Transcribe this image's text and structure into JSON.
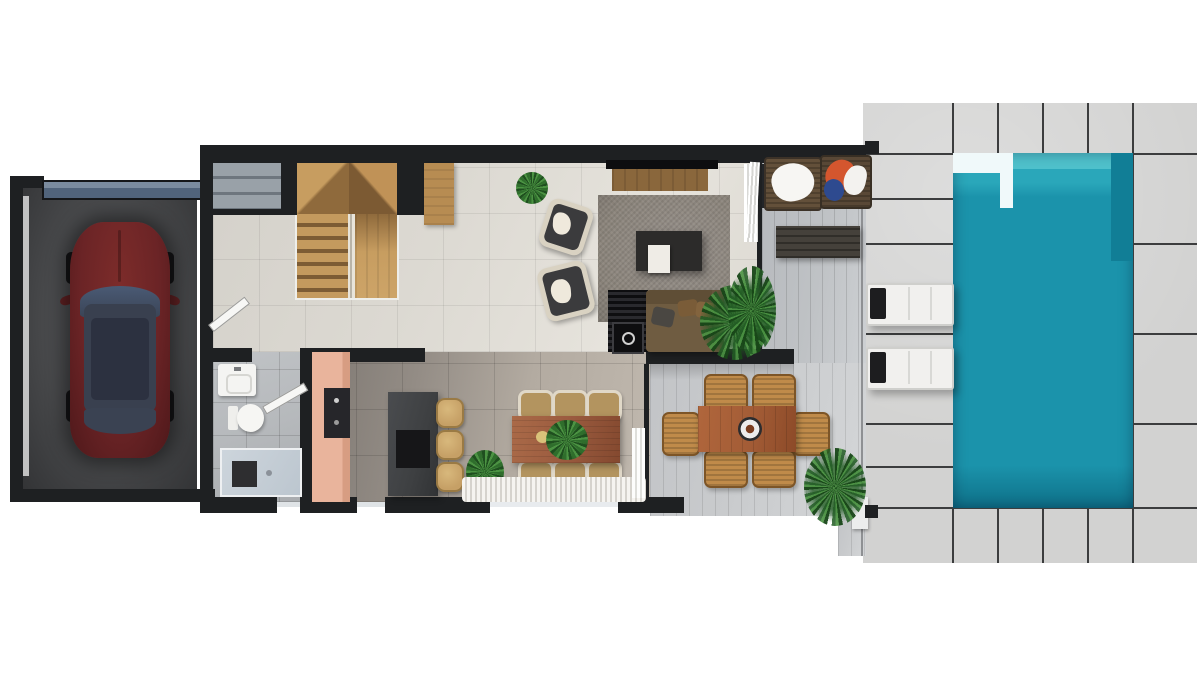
{
  "scene": {
    "type": "architectural-floor-plan-render",
    "view": "top-down",
    "floor": "ground-floor-with-pool",
    "background": "#ffffff",
    "visible_text": "none"
  },
  "palette": {
    "wall": "#1e2022",
    "floorLiving": "#dcd9d2",
    "floorKitchen": "#a89f96",
    "floorBath": "#b6b9bc",
    "deck": "#c9cbcd",
    "terrace": "#bfc2c5",
    "paver": "#d2d2d1",
    "paverGap": "#3c3d3e",
    "pool": "#1b93ab",
    "poolLight": "#4fc1cc",
    "poolDark": "#117e96",
    "poolLedge": "#f0f9fa",
    "stairWood": "#c79d60",
    "stairWoodDark": "#8f6a3c",
    "carBody": "#6b2426",
    "carGlass": "#39404f",
    "rug": "#8b847b",
    "sofa": "#6f5c41",
    "tvConsoleWood": "#8a673c",
    "diningTableWood": "#9b5b3f",
    "outdoorTableWood": "#a35c36",
    "wicker": "#c08b4a",
    "stool": "#c6a066",
    "chairFrame": "#e0d8c8",
    "chairSeat": "#b3945f",
    "cabinetPink": "#e9b49c",
    "island": "#3e4042",
    "garageFloor": "#47484a",
    "garageDoor": "#51647c",
    "lounger": "#f1f0ee",
    "bench": "#45413b",
    "entrySteps": "#8d959c",
    "towelOrange": "#d4562e",
    "towelBlue": "#2e4a8f",
    "plantGreen": "#3a7d36"
  },
  "rooms": [
    {
      "name": "garage",
      "items": [
        "dark-red-car",
        "garage-door",
        "concrete-floor"
      ]
    },
    {
      "name": "entry",
      "items": [
        "exterior-concrete-steps"
      ]
    },
    {
      "name": "staircase",
      "items": [
        "u-shaped-wooden-stairs",
        "glass-railing",
        "wood-landing"
      ]
    },
    {
      "name": "hallway",
      "items": [
        "garage-interior-door",
        "bathroom-interior-door"
      ]
    },
    {
      "name": "bathroom",
      "items": [
        "sink",
        "toilet",
        "walk-in-shower",
        "dark-shower-mat"
      ]
    },
    {
      "name": "kitchen",
      "items": [
        "pink-cabinet-run",
        "built-in-range",
        "dark-island",
        "bar-stool",
        "bar-stool",
        "bar-stool"
      ]
    },
    {
      "name": "dining-room",
      "items": [
        "wood-dining-table",
        "dining-chair-x6",
        "table-plant",
        "floor-plant",
        "fringe-rug",
        "white-curtain"
      ]
    },
    {
      "name": "living-room",
      "items": [
        "tv",
        "tv-console",
        "gray-area-rug",
        "black-coffee-table",
        "white-tray",
        "brown-sofa",
        "media-unit-with-speaker",
        "armchair",
        "armchair",
        "potted-plant",
        "wood-sideboard",
        "palm-plant",
        "white-curtain"
      ]
    },
    {
      "name": "covered-deck",
      "items": [
        "outdoor-wood-table",
        "fire-bowl",
        "wicker-chair-x6",
        "palm-plant",
        "overhead-beam"
      ]
    },
    {
      "name": "upper-terrace",
      "items": [
        "wicker-lounger-with-white-towel",
        "wicker-lounger-with-orange-blue-towels",
        "slatted-bench",
        "palm-plant",
        "white-curtain"
      ]
    },
    {
      "name": "pool-area",
      "items": [
        "turquoise-swimming-pool",
        "white-pool-ledge",
        "stone-paver-deck",
        "white-sun-lounger",
        "white-sun-lounger",
        "corner-pillar",
        "corner-pillar"
      ]
    }
  ]
}
